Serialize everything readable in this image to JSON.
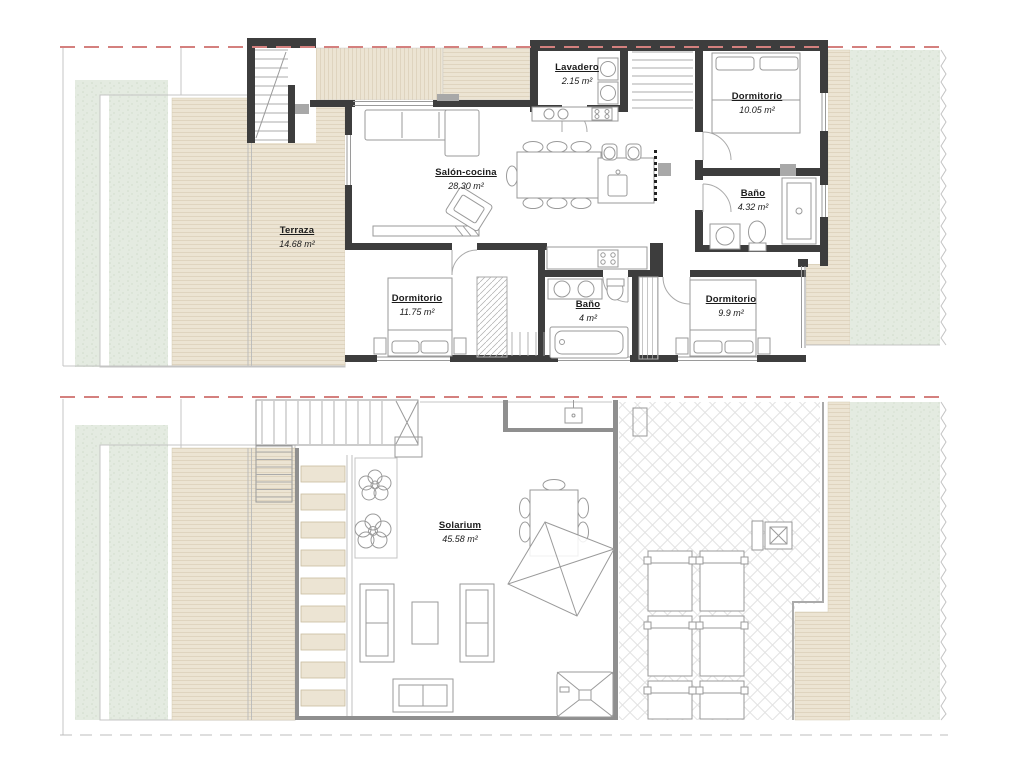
{
  "colors": {
    "wall": "#3d3d3d",
    "thin_wall": "#8f8f8f",
    "deck": "#ece4d3",
    "deck_line": "#dcd1ba",
    "lawn": "#e4ebe1",
    "boundary_red": "#d4807e",
    "furniture_line": "#9a9a9a",
    "label_text": "#1b1b1b",
    "pier_gray": "#a8a8a8"
  },
  "plans": [
    {
      "id": "first-floor-plan",
      "rooms": [
        {
          "name": "Terraza",
          "area": "14.68 m²"
        },
        {
          "name": "Salón-cocina",
          "area": "28.30 m²"
        },
        {
          "name": "Lavadero",
          "area": "2.15 m²"
        },
        {
          "name": "Dormitorio",
          "area": "10.05 m²"
        },
        {
          "name": "Baño",
          "area": "4.32 m²"
        },
        {
          "name": "Dormitorio",
          "area": "11.75 m²"
        },
        {
          "name": "Baño",
          "area": "4 m²"
        },
        {
          "name": "Dormitorio",
          "area": "9.9 m²"
        }
      ]
    },
    {
      "id": "solarium-plan",
      "rooms": [
        {
          "name": "Solarium",
          "area": "45.58 m²"
        }
      ]
    }
  ]
}
